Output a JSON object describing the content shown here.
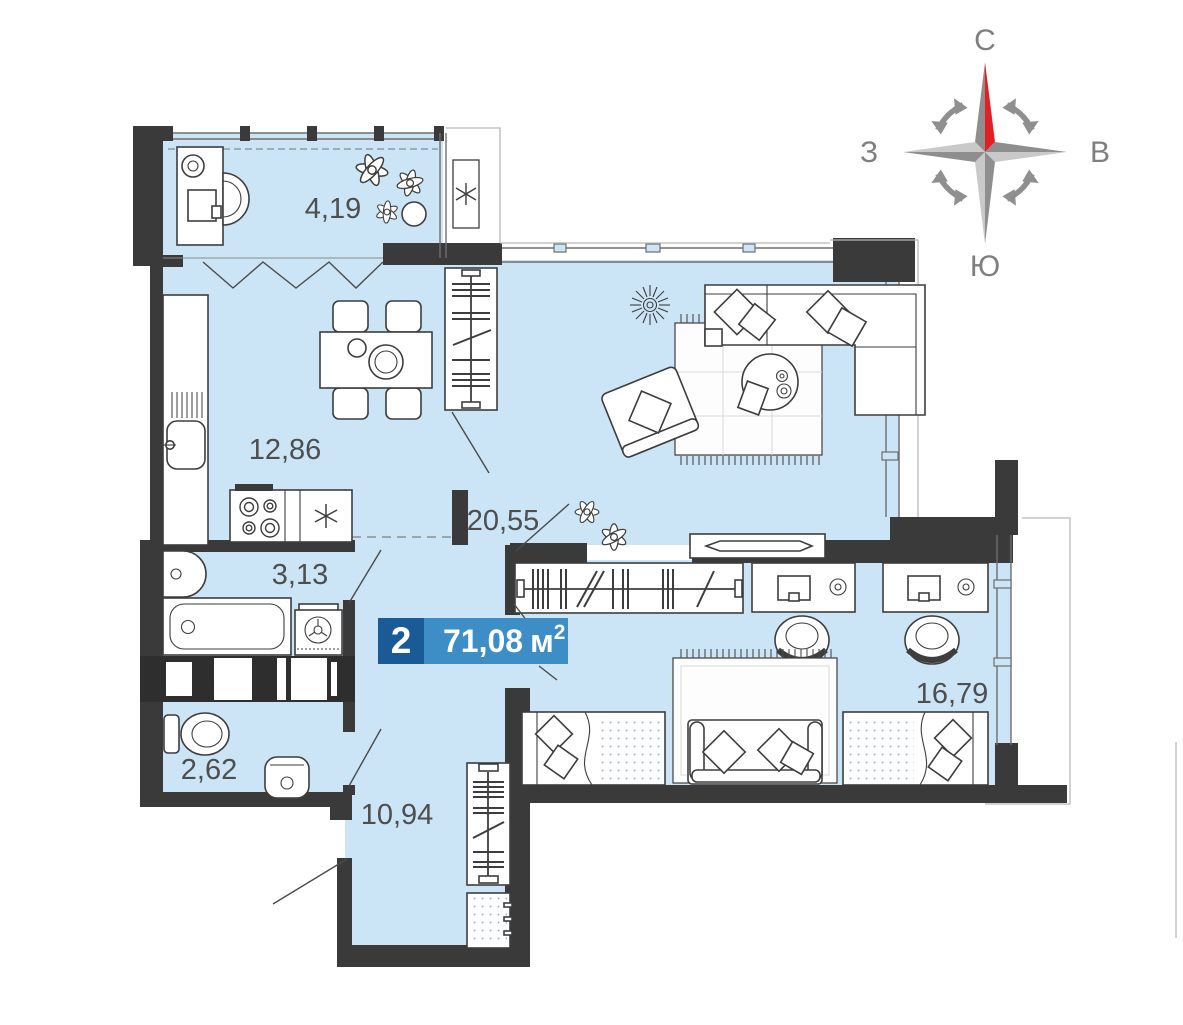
{
  "plan": {
    "badge": {
      "rooms_count": "2",
      "area_value": "71,08",
      "area_unit": "м",
      "area_superscript": "2"
    },
    "rooms": [
      {
        "id": "loggia",
        "area": "4,19"
      },
      {
        "id": "kitchen_dining",
        "area": "12,86"
      },
      {
        "id": "living",
        "area": "20,55"
      },
      {
        "id": "bathroom",
        "area": "3,13"
      },
      {
        "id": "wc",
        "area": "2,62"
      },
      {
        "id": "hallway",
        "area": "10,94"
      },
      {
        "id": "bedroom",
        "area": "16,79"
      }
    ]
  },
  "compass": {
    "north_label": "С",
    "east_label": "В",
    "south_label": "Ю",
    "west_label": "З"
  },
  "colors": {
    "floor": "#cbe5f7",
    "wall": "#3a3a3a",
    "badge_dark": "#1a5a96",
    "badge_light": "#3d8dc6",
    "compass_red": "#e31e25"
  }
}
